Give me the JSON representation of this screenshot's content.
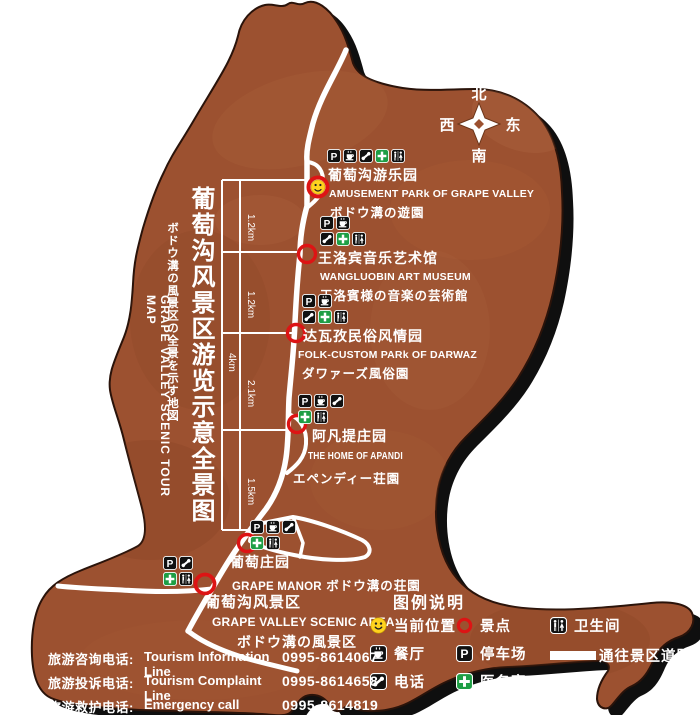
{
  "map_title": {
    "zh": "葡萄沟风景区游览示意全景图",
    "ja": "ボドウ溝の風景区の全景を示す地図",
    "en": "GRAPE  VALLEY  SCENIC  TOUR  MAP"
  },
  "compass": {
    "north": "北",
    "south": "南",
    "east": "东",
    "west": "西"
  },
  "scale_markers": {
    "segments": [
      "1.2km",
      "1.2km",
      "2.1km",
      "1.5km"
    ],
    "total": "4km"
  },
  "pois": [
    {
      "name_zh": "葡萄沟游乐园",
      "name_en": "AMUSEMENT PARk OF GRAPE VALLEY",
      "name_ja": "ボドウ溝の遊園",
      "marker": "current-location-icon",
      "icon_rows": [
        [
          "parking-icon",
          "restaurant-icon",
          "phone-icon",
          "medical-icon",
          "toilet-icon"
        ]
      ]
    },
    {
      "name_zh": "王洛宾音乐艺术馆",
      "name_en": "WANGLUOBIN ART MUSEUM",
      "name_ja": "王洛賓様の音楽の芸術館",
      "marker": "scenic-spot-icon",
      "icon_rows": [
        [
          "parking-icon",
          "restaurant-icon"
        ],
        [
          "phone-icon",
          "medical-icon",
          "toilet-icon"
        ]
      ]
    },
    {
      "name_zh": "达瓦孜民俗风情园",
      "name_en": "FOLK-CUSTOM PARk OF DARWAZ",
      "name_ja": "ダワァーズ風俗園",
      "marker": "scenic-spot-icon",
      "icon_rows": [
        [
          "parking-icon",
          "restaurant-icon"
        ],
        [
          "phone-icon",
          "medical-icon",
          "toilet-icon"
        ]
      ]
    },
    {
      "name_zh": "阿凡提庄园",
      "name_en": "THE HOME OF APANDI",
      "name_ja": "エペンディー荘園",
      "marker": "scenic-spot-icon",
      "icon_rows": [
        [
          "parking-icon",
          "restaurant-icon",
          "phone-icon"
        ],
        [
          "medical-icon",
          "toilet-icon"
        ]
      ]
    },
    {
      "name_zh": "葡萄庄园",
      "name_en": "GRAPE MANOR",
      "name_ja": "ボドウ溝の荘園",
      "marker": "scenic-spot-icon",
      "icon_rows": [
        [
          "parking-icon",
          "restaurant-icon",
          "phone-icon"
        ],
        [
          "medical-icon",
          "toilet-icon"
        ]
      ]
    },
    {
      "name_zh": "葡萄沟风景区",
      "name_en": "GRAPE VALLEY SCENIC AREA",
      "name_ja": "ボドウ溝の風景区",
      "marker": "scenic-spot-icon",
      "icon_rows": [
        [
          "parking-icon",
          "phone-icon"
        ],
        [
          "medical-icon",
          "toilet-icon"
        ]
      ]
    }
  ],
  "legend": {
    "title": "图例说明",
    "items": [
      {
        "icon": "current-location-icon",
        "label": "当前位置"
      },
      {
        "icon": "scenic-spot-icon",
        "label": "景点"
      },
      {
        "icon": "toilet-icon",
        "label": "卫生间"
      },
      {
        "icon": "restaurant-icon",
        "label": "餐厅"
      },
      {
        "icon": "parking-icon",
        "label": "停车场"
      },
      {
        "icon": "road-icon",
        "label": "通往景区道路"
      },
      {
        "icon": "phone-icon",
        "label": "电话"
      },
      {
        "icon": "medical-icon",
        "label": "医务室"
      }
    ]
  },
  "hotlines": [
    {
      "label_zh": "旅游咨询电话:",
      "label_en": "Tourism Information Line",
      "number": "0995-8614067"
    },
    {
      "label_zh": "旅游投诉电话:",
      "label_en": "Tourism  Complaint  Line",
      "number": "0995-8614658"
    },
    {
      "label_zh": "旅游救护电话:",
      "label_en": "Emergency  call",
      "number": "0995-8614819"
    }
  ],
  "colors": {
    "map_fill": "#9c5130",
    "outline": "#0f0f0f",
    "road": "#ffffff",
    "scenic_spot_ring": "#dd1414",
    "medical_green": "#1e9e45",
    "smiley_yellow": "#ffd21e"
  }
}
